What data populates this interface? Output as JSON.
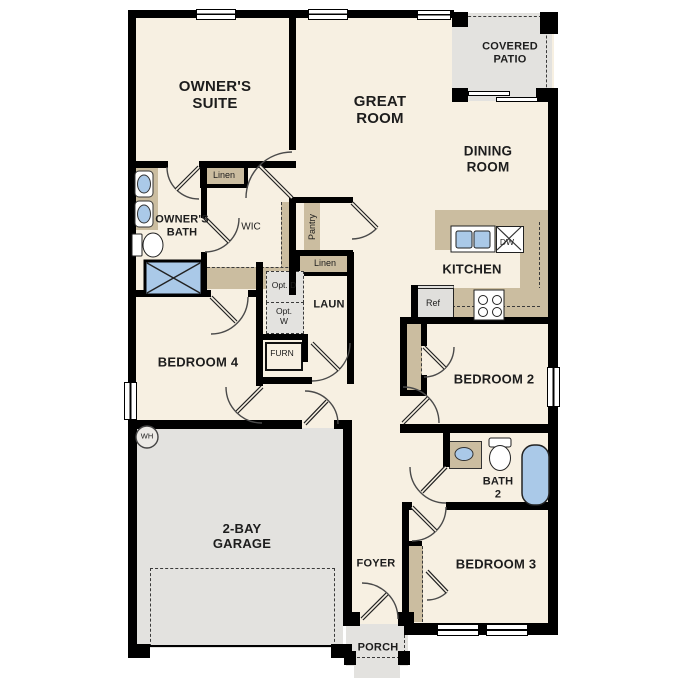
{
  "plan_title": "Single-story floor plan",
  "rooms": {
    "owners_suite": "OWNER'S SUITE",
    "great_room": "GREAT ROOM",
    "covered_patio": "COVERED PATIO",
    "dining_room": "DINING ROOM",
    "owners_bath": "OWNER'S BATH",
    "wic": "WIC",
    "kitchen": "KITCHEN",
    "laundry": "LAUN",
    "bedroom_4": "BEDROOM 4",
    "bedroom_2": "BEDROOM 2",
    "bath_2": "BATH 2",
    "bedroom_3": "BEDROOM 3",
    "garage": "2-BAY GARAGE",
    "foyer": "FOYER",
    "porch": "PORCH"
  },
  "closets": {
    "linen_upper": "Linen",
    "pantry": "Pantry",
    "linen_hall": "Linen"
  },
  "fixtures": {
    "dishwasher": "DW",
    "refrigerator": "Ref",
    "furnace": "FURN",
    "water_heater": "WH",
    "optional_dryer": "Opt. D",
    "optional_washer": "Opt. W"
  },
  "palette": {
    "wall": "#000000",
    "room_fill": "#f7f0e2",
    "outdoor_fill": "#e3e2df",
    "cabinet_tan": "#cbbda0",
    "fixture_blue": "#aac9e8",
    "dash_line": "#3a3a3a"
  }
}
